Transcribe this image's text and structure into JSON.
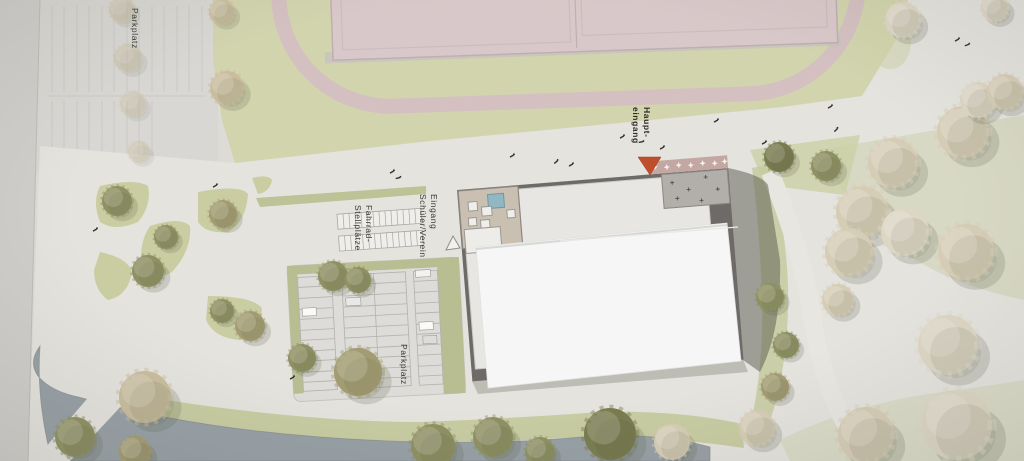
{
  "plan": {
    "labels": {
      "parkplatz_top": "Parkplatz",
      "haupteingang": "Haupt-\neingang",
      "eingang_schueler_verein": "Eingang\nSchüler/Verein",
      "fahrrad_stellplaetze": "Fahrrad-\nStellplätze",
      "parkplatz_bottom": "Parkplatz"
    },
    "icons": {
      "haupteingang_arrow": "red-triangle-down",
      "eingang_arrow": "white-triangle-up"
    },
    "colors": {
      "path": "#e4e3de",
      "grass": "#d2d4ae",
      "track_pink": "#d4c0c1",
      "sports_field_pink": "#d9c8c9",
      "water": "#97a0a6",
      "building_roof_dark": "#6e6a67",
      "building_roof_light": "#e7e6e2",
      "white_roof_sheet": "#f6f6f7",
      "courtyard_beige": "#c9c0b1",
      "pool_blue": "#91b7c3",
      "entrance_red": "#bf4f2c",
      "hedge_green": "#b8be92"
    }
  }
}
